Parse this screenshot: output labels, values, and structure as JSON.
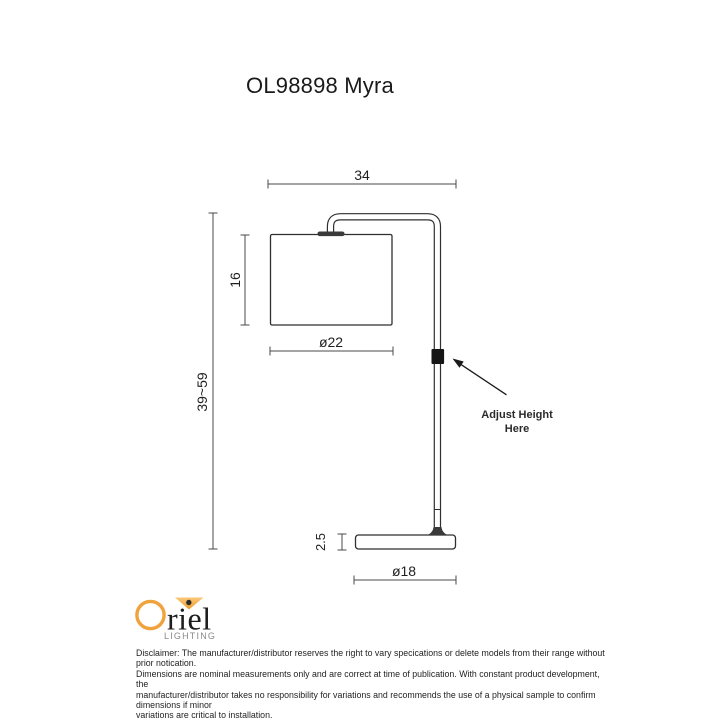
{
  "page": {
    "title": "OL98898 Myra"
  },
  "diagram": {
    "dimensions": {
      "overall_width": "34",
      "shade_height": "16",
      "shade_diameter": "ø22",
      "overall_height_range": "39~59",
      "base_height": "2.5",
      "base_diameter": "ø18"
    },
    "annotation": {
      "line1": "Adjust Height",
      "line2": "Here"
    },
    "colors": {
      "line": "#2f2f2f",
      "dimension_line": "#4a4a4a",
      "adjuster_block": "#161616"
    }
  },
  "footer": {
    "logo": {
      "brand_rest": "riel",
      "subtitle": "LIGHTING",
      "accent_orange": "#f0a33c"
    },
    "disclaimer": "Disclaimer: The manufacturer/distributor reserves the right to vary specications or delete models from their range without prior notication.\nDimensions are nominal measurements only and are correct at time of publication. With constant product development, the\nmanufacturer/distributor takes no responsibility for variations and recommends the use of a physical sample to confirm dimensions if minor\nvariations are critical to installation."
  }
}
